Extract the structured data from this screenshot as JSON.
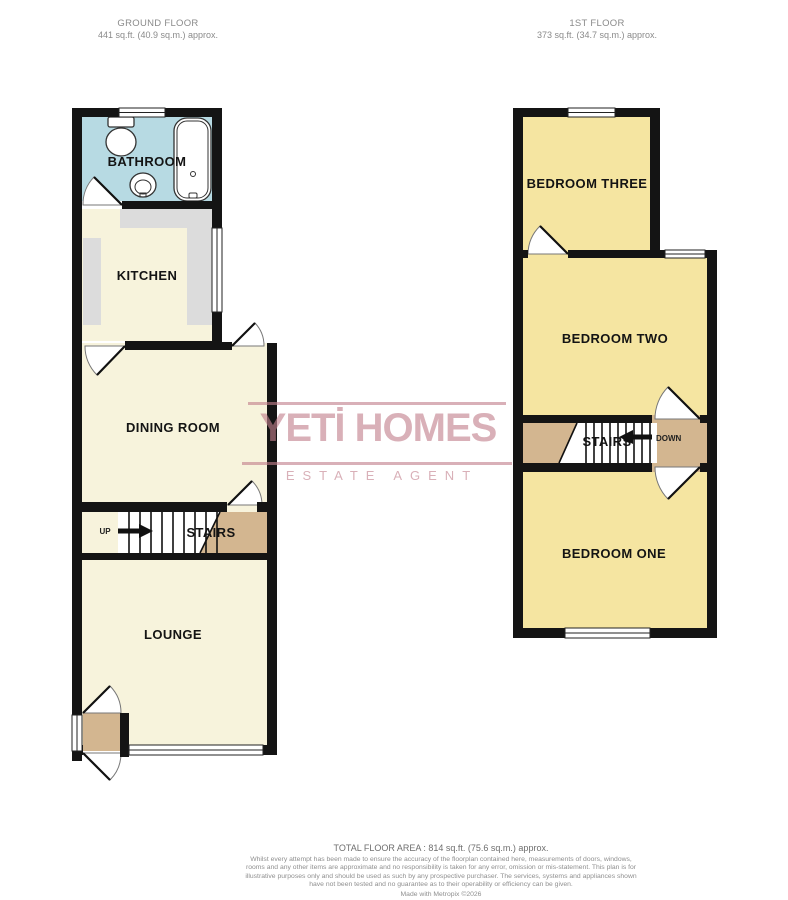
{
  "headers": {
    "ground": {
      "title": "GROUND FLOOR",
      "area": "441 sq.ft. (40.9 sq.m.) approx."
    },
    "first": {
      "title": "1ST FLOOR",
      "area": "373 sq.ft. (34.7 sq.m.) approx."
    }
  },
  "watermark": {
    "brand": "YETİ HOMES",
    "tagline": "ESTATE AGENT"
  },
  "ground_floor": {
    "rooms": {
      "bathroom": "BATHROOM",
      "kitchen": "KITCHEN",
      "dining": "DINING ROOM",
      "stairs": "STAIRS",
      "lounge": "LOUNGE"
    },
    "stairs_direction": "UP"
  },
  "first_floor": {
    "rooms": {
      "bedroom_three": "BEDROOM THREE",
      "bedroom_two": "BEDROOM TWO",
      "stairs": "STAIRS",
      "bedroom_one": "BEDROOM ONE"
    },
    "stairs_direction": "DOWN"
  },
  "footer": {
    "total": "TOTAL FLOOR AREA : 814 sq.ft. (75.6 sq.m.) approx.",
    "disclaimer": "Whilst every attempt has been made to ensure the accuracy of the floorplan contained here, measurements of doors, windows, rooms and any other items are approximate and no responsibility is taken for any error, omission or mis-statement. This plan is for illustrative purposes only and should be used as such by any prospective purchaser. The services, systems and appliances shown have not been tested and no guarantee as to their operability or efficiency can be given.",
    "credit": "Made with Metropix ©2026"
  },
  "colors": {
    "wall": "#141414",
    "ground-room": "#f7f3dc",
    "first-room": "#f5e5a1",
    "bathroom": "#b7dae3",
    "landing": "#d3b690",
    "counter": "#dcdcdc",
    "brand": "#c2808d"
  }
}
